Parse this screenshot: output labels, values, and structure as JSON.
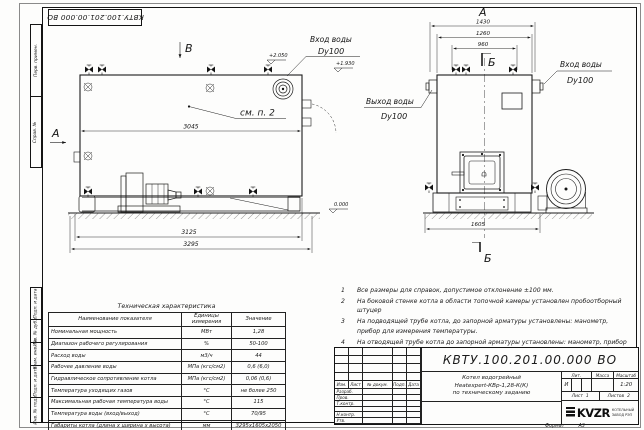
{
  "stamp": {
    "doc_number": "КВТУ.100.201.00.000 ВО"
  },
  "frame_labels": {
    "top": [
      "Перв. примен.",
      "Справ. №"
    ],
    "bottom": [
      "Подп. и дата",
      "Инв. № дубл.",
      "Взам. инв. №",
      "Подп. и дата",
      "Инв. № подл."
    ]
  },
  "side_view": {
    "view_arrow_a": "А",
    "view_arrow_b": "В",
    "note_ref": "см. п. 2",
    "inlet_label": "Вход воды",
    "inlet_dn": "Dy100",
    "elev_top": "+2.050",
    "elev_mid": "+1.930",
    "elev_zero": "0.000",
    "dim_width": "3045",
    "dim_base": "3125",
    "dim_total": "3295"
  },
  "front_view": {
    "view_label": "А",
    "section_top": "Б",
    "section_bottom": "Б",
    "dim_total": "1430",
    "dim_body": "1260",
    "dim_valves": "960",
    "dim_base": "1605",
    "outlet_label": "Выход воды",
    "outlet_dn": "Dy100",
    "inlet_label": "Вход воды",
    "inlet_dn": "Dy100"
  },
  "notes": {
    "items": [
      {
        "num": "1",
        "text": "Все размеры для справок, допустимое отклонение ±100 мм."
      },
      {
        "num": "2",
        "text": "На боковой стенке котла в области топочной камеры установлен пробоотборный штуцер"
      },
      {
        "num": "3",
        "text": "На подводящей трубе котла, до запорной арматуры установлены: манометр, прибор для измерения температуры."
      },
      {
        "num": "4",
        "text": "На отводящей трубе котла до запорной арматуры установлены: манометр, прибор для измерения температуры, предохранительный клапан Dу не менее 50 мм и отвод с обратным клапаном Dу не менее 50 мм."
      }
    ]
  },
  "tech_table": {
    "title": "Техническая характеристика",
    "headers": [
      "Наименование показателя",
      "Единицы измерения",
      "Значение"
    ],
    "rows": [
      [
        "Номинальная мощность",
        "МВт",
        "1,28"
      ],
      [
        "Диапазон рабочего регулирования",
        "%",
        "50-100"
      ],
      [
        "Расход воды",
        "м3/ч",
        "44"
      ],
      [
        "Рабочее давление воды",
        "МПа (кгс/см2)",
        "0,6 (6,0)"
      ],
      [
        "Гидравлическое сопротивление котла",
        "МПа (кгс/см2)",
        "0,06 (0,6)"
      ],
      [
        "Температура уходящих газов",
        "°С",
        "не более 250"
      ],
      [
        "Максимальная рабочая температура воды",
        "°С",
        "115"
      ],
      [
        "Температура воды (вход/выход)",
        "°С",
        "70/95"
      ],
      [
        "Габариты котла (длина х ширина х высота)",
        "мм",
        "3295х1605х2050"
      ]
    ]
  },
  "title_block": {
    "doc_number": "КВТУ.100.201.00.000  ВО",
    "product_line1": "Котел водогрейный",
    "product_line2": "Heatexpert-КВр-1,28-К(К)",
    "product_line3": "по техническому заданию",
    "rev_headers": [
      "Изм.",
      "Лист",
      "№ докум.",
      "Подп.",
      "Дата"
    ],
    "sign_rows": [
      "Разраб.",
      "Пров.",
      "Т.контр.",
      "",
      "Н.контр.",
      "Утв."
    ],
    "lit_label": "Лит.",
    "lit_value": "И",
    "mass_label": "Масса",
    "scale_label": "Масштаб",
    "scale_value": "1:20",
    "sheet_label": "Лист",
    "sheet_value": "1",
    "sheets_label": "Листов",
    "sheets_value": "2",
    "logo_text": "KVZR",
    "company_line1": "КОТЕЛЬНЫЙ",
    "company_line2": "ЗАВОД РЭП"
  },
  "footer": {
    "format_label": "Формат",
    "format_value": "А3"
  }
}
